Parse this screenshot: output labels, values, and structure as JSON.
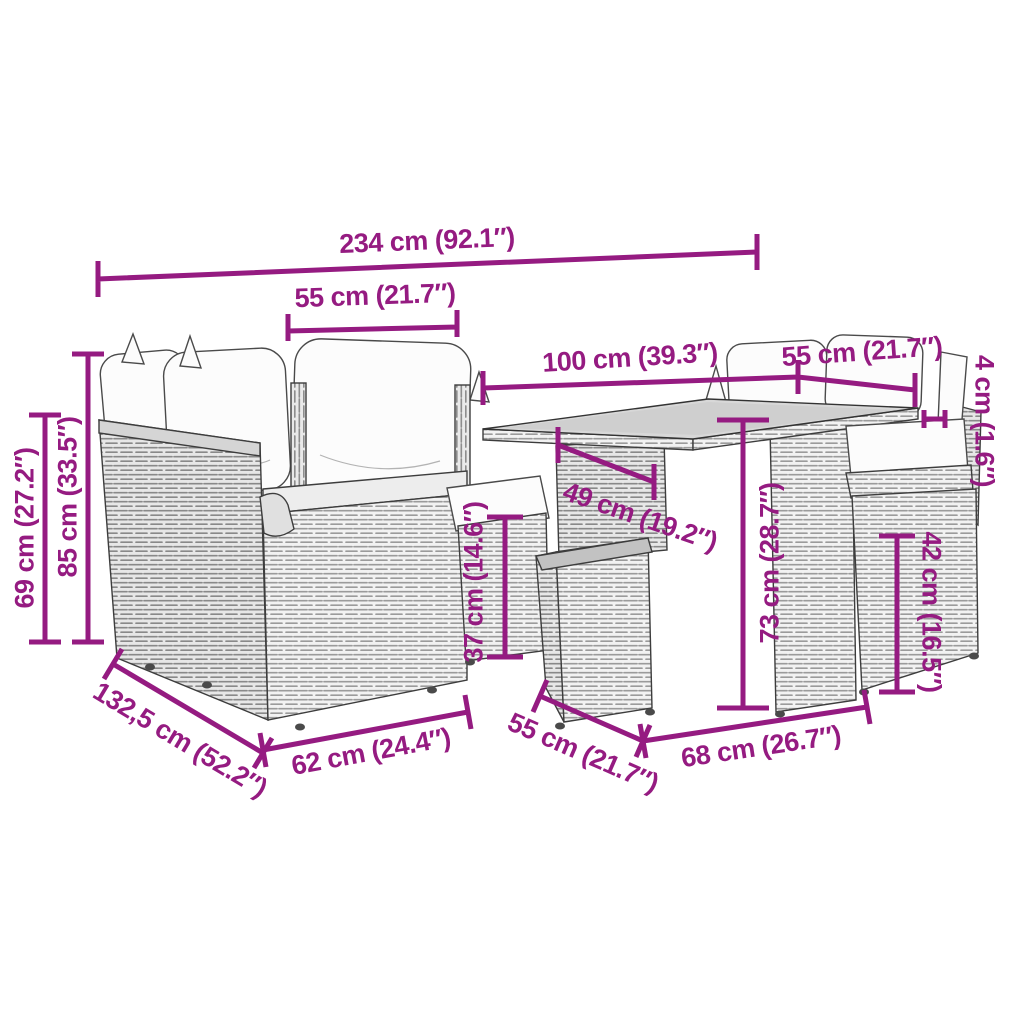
{
  "figure": {
    "subject": "Poly rattan garden lounge furniture set with cushions and table — product dimension diagram",
    "accent_color": "#951B81",
    "background_color": "#ffffff"
  },
  "dims": [
    {
      "id": "total-width",
      "label": "234 cm (92.1″)"
    },
    {
      "id": "left-seat-width",
      "label": "55 cm (21.7″)"
    },
    {
      "id": "table-length",
      "label": "100 cm (39.3″)"
    },
    {
      "id": "right-seat-width",
      "label": "55 cm (21.7″)"
    },
    {
      "id": "tabletop-thickness",
      "label": "4 cm (1.6″)"
    },
    {
      "id": "back-height",
      "label": "69 cm (27.2″)"
    },
    {
      "id": "total-height",
      "label": "85 cm (33.5″)"
    },
    {
      "id": "table-leg-width",
      "label": "49 cm (19.2″)"
    },
    {
      "id": "stool-height",
      "label": "37 cm (14.6″)"
    },
    {
      "id": "table-height",
      "label": "73 cm (28.7″)"
    },
    {
      "id": "base-height",
      "label": "42 cm (16.5″)"
    },
    {
      "id": "total-depth",
      "label": "132,5 cm (52.2″)"
    },
    {
      "id": "left-base-width",
      "label": "62 cm (24.4″)"
    },
    {
      "id": "stool-depth",
      "label": "55 cm (21.7″)"
    },
    {
      "id": "right-base-width",
      "label": "68 cm (26.7″)"
    }
  ]
}
